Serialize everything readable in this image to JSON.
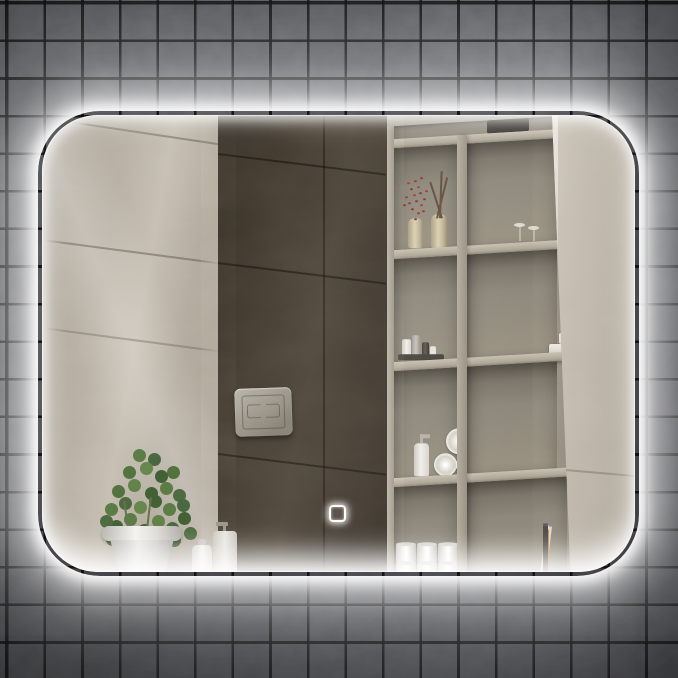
{
  "image": {
    "kind": "product-photo",
    "subject": "LED backlit rectangular wall mirror with rounded corners and white halo glow, mounted on a dark grey square-tile wall, reflecting a bathroom interior",
    "width_px": 678,
    "height_px": 678
  },
  "wall": {
    "tile_color": "#505154",
    "grout_color": "#0a0a0b",
    "tile_size_px": 37
  },
  "mirror": {
    "x_px": 42,
    "y_px": 115,
    "width_px": 593,
    "height_px": 457,
    "corner_radius_px": 56,
    "glow_color": "#ffffff",
    "touch_button": {
      "name": "touch sensor button",
      "shape": "rounded-square outline",
      "color": "#ffffff",
      "x_px": 331,
      "y_px": 505
    }
  },
  "reflection": {
    "left_wall": {
      "material": "beige marble tile",
      "color": "#b2aa9d"
    },
    "center_wall": {
      "material": "dark brown marble tile",
      "color": "#3f382e"
    },
    "flush_plate": {
      "material": "brushed metal",
      "color": "#989287"
    },
    "shelving_unit": {
      "frame_color": "#a29b8e",
      "items": [
        "vases with red berry branches",
        "white bird figurines",
        "toiletry bottle cluster on tray",
        "white soap boxes",
        "black alarm clock",
        "white pump bottle",
        "rolled white towels",
        "faceted white sphere lamp",
        "stacked toilet paper rolls",
        "row of books"
      ],
      "book_spine_colors": [
        "#e3e0d7",
        "#557162",
        "#c2c8b4",
        "#3a5a50",
        "#8fae9c",
        "#2f4d45",
        "#d8d5cc",
        "#746084",
        "#c98440",
        "#4a4440"
      ]
    },
    "right_wall": {
      "material": "beige marble tile",
      "color": "#c4bdb0"
    },
    "plant": {
      "foliage_color": "#4d6a3a",
      "pot_color": "#e9e7e2"
    },
    "ledge_accessories": [
      "white lotion bottle",
      "soap dispenser with chrome pump"
    ]
  },
  "palette": {
    "glow": "#ffffff",
    "tile": "#505154",
    "grout": "#0a0a0b",
    "beige_marble": "#b2aa9d",
    "dark_marble": "#3f382e",
    "shelf": "#a29b8e"
  }
}
